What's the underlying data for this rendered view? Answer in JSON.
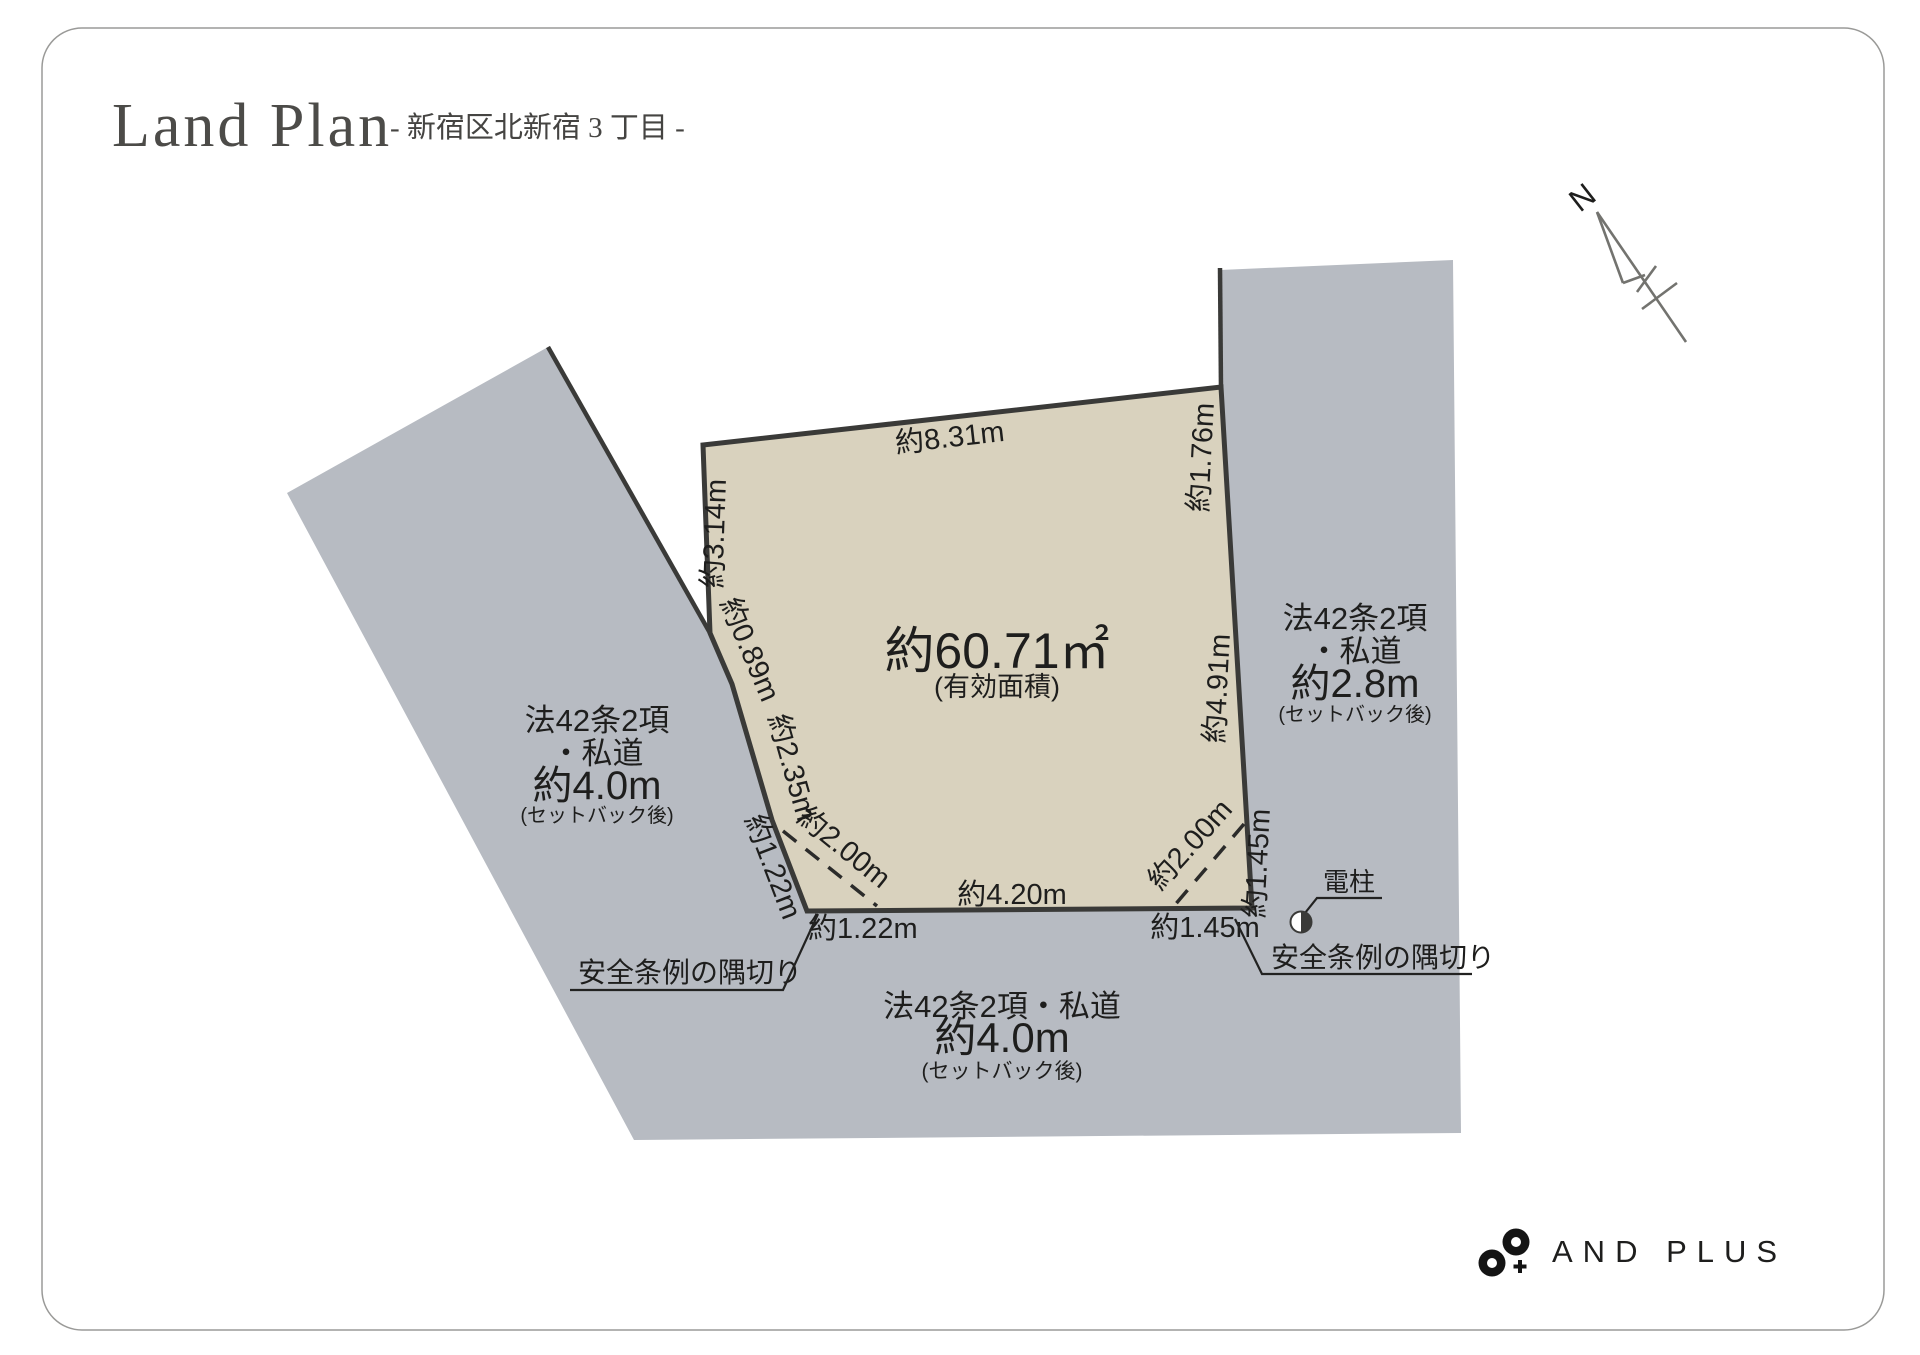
{
  "header": {
    "title": "Land Plan",
    "subtitle": "- 新宿区北新宿 3 丁目 -"
  },
  "compass": {
    "north_label": "N"
  },
  "parcel": {
    "area_main": "約60.71㎡",
    "area_sub": "(有効面積)",
    "dim_top": "約8.31m",
    "dim_left_upper": "約3.14m",
    "dim_left_mid": "約0.89m",
    "dim_left_lower": "約2.35m",
    "dim_cut_left_edge": "約1.22m",
    "dim_cut_left_dashed": "約2.00m",
    "dim_cut_left_bottom": "約1.22m",
    "dim_bottom": "約4.20m",
    "dim_right_upper": "約1.76m",
    "dim_right_main": "約4.91m",
    "dim_cut_right_edge": "約1.45m",
    "dim_cut_right_dashed": "約2.00m",
    "dim_cut_right_bottom": "約1.45m"
  },
  "roads": {
    "left": {
      "line1": "法42条2項",
      "line2": "・私道",
      "line3": "約4.0m",
      "line4": "(セットバック後)"
    },
    "right": {
      "line1": "法42条2項",
      "line2": "・私道",
      "line3": "約2.8m",
      "line4": "(セットバック後)"
    },
    "bottom": {
      "line1": "法42条2項・私道",
      "line2": "約4.0m",
      "line3": "(セットバック後)"
    }
  },
  "annotations": {
    "corner_cut_left": "安全条例の隅切り",
    "corner_cut_right": "安全条例の隅切り",
    "utility_pole": "電柱"
  },
  "logo": {
    "text": "AND PLUS"
  },
  "colors": {
    "road_fill": "#b7bbc2",
    "parcel_fill": "#d9d2be",
    "line": "#3a3a38",
    "text": "#1e1e1d",
    "frame": "#9a9a98"
  }
}
